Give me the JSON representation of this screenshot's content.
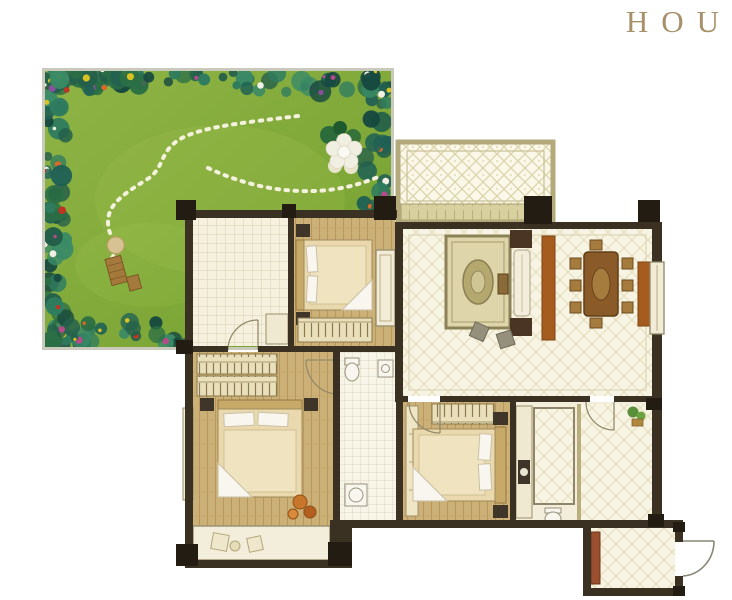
{
  "brand": {
    "text": "HOU"
  },
  "palette": {
    "background": "#ffffff",
    "brand_gold": "#a8906a",
    "wall_dark": "#3a3122",
    "wall_column": "#221c12",
    "floor_cream": "#f3eedb",
    "tile_bg": "#f5f1de",
    "tile_line": "#d7cfae",
    "diamond_bg": "#f8f4e3",
    "diamond_line": "#e4dcba",
    "wood_floor": "#cbb077",
    "wood_line": "#b69556",
    "lawn_green": "#79a636",
    "lawn_light": "#93b944",
    "bush_teal": "#1f6055",
    "bush_green": "#2f7c5f",
    "flower_red": "#c03425",
    "flower_yellow": "#d9c322",
    "flower_pink": "#b84a8a",
    "flower_white": "#f2f0e4",
    "flower_purple": "#8a4f9e",
    "path_stone": "#f4f1dd",
    "balcony_frame": "#b3a97a",
    "furniture_rust": "#a65c1e",
    "furniture_brown": "#8a5a28",
    "furniture_dark": "#3f3629",
    "linen_white": "#f8f6ee",
    "rug_beige": "#ded5ab"
  },
  "rooms": [
    "garden",
    "kitchen",
    "bedroom-2",
    "balcony",
    "living-dining",
    "master-bedroom",
    "bathroom-1",
    "bedroom-3",
    "bathroom-2",
    "entry-hall"
  ]
}
